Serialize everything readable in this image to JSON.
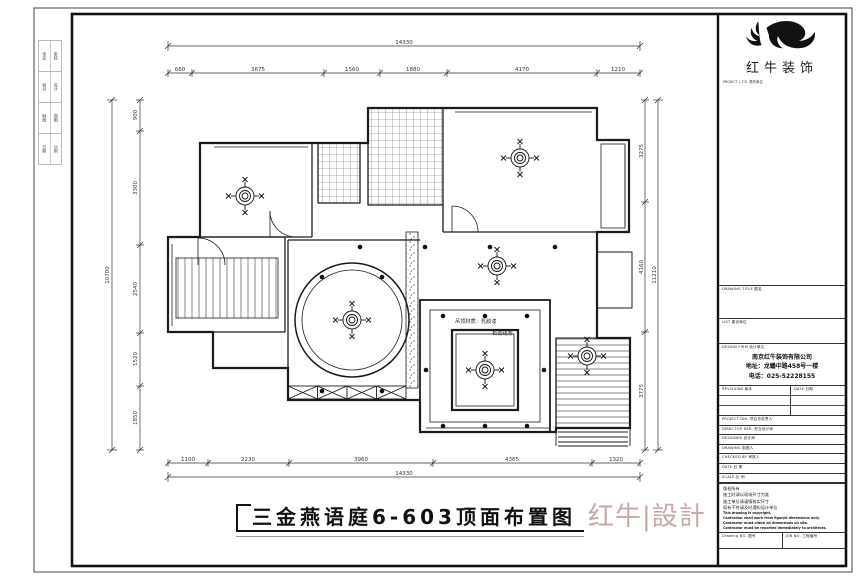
{
  "sheet": {
    "binding_strip": [
      {
        "a": "审定",
        "b": "审核"
      },
      {
        "a": "校对",
        "b": "设计"
      },
      {
        "a": "制图",
        "b": "描图"
      },
      {
        "a": "日期",
        "b": "比例"
      }
    ]
  },
  "logo": {
    "name": "红牛装饰",
    "project_label": "PROJECT L.T.D.  委托单位"
  },
  "title_block": {
    "drawing_title_label": "DRAWING TITLE  图名",
    "client_label": "LIST  建设单位",
    "design_firm_label": "DESIGN FIRM  设计单位",
    "firm_name": "南京红牛装饰有限公司",
    "firm_address": "地址：龙蟠中路458号一楼",
    "firm_phone": "电话：025-52228155",
    "revisions_label": "REVISIONS  版本",
    "revisions_date_label": "DATE  日期",
    "row_labels": [
      "PROJECT DIR.  项目总负责人",
      "DIRECTOR DER.  担当设计师",
      "DESIGNER  设计师",
      "DRAWING  制图人",
      "CHECKED BY  审核人",
      "DATE  日 期",
      "SCALE  比 例"
    ],
    "notes": [
      "版权所有",
      "施工时请以现场尺寸为准",
      "施工单位请谨慎核实尺寸",
      "如有不符请及时通知设计单位",
      "This drawing is copyright.",
      "Contractor shall work from figured dimensions only.",
      "Contractor must check all dimensions on site.",
      "Contractor must be reported immediately to architects."
    ],
    "drawing_no_label": "Drawing NO.  图号",
    "job_no_label": "JOB NO.  工程编号"
  },
  "plan": {
    "annotations": {
      "line1": "吊顶材质：乳胶漆",
      "line2": "石膏线条"
    },
    "dims": {
      "top_overall": "14330",
      "top_segments": [
        "660",
        "3675",
        "1560",
        "1880",
        "4170",
        "1210"
      ],
      "bottom_segments": [
        "1100",
        "2230",
        "3960",
        "4365",
        "1320"
      ],
      "bottom_overall": "14330",
      "left_overall": "10700",
      "left_segments": [
        "900",
        "3300",
        "2540",
        "1520",
        "1850"
      ],
      "right_segments": [
        "3275",
        "4160",
        "3775"
      ],
      "right_overall": "11210"
    }
  },
  "footer": {
    "title": "三金燕语庭6-603顶面布置图",
    "watermark": "红牛|設計"
  },
  "colors": {
    "line": "#1b1b1b",
    "watermark": "#c9a6a6"
  }
}
